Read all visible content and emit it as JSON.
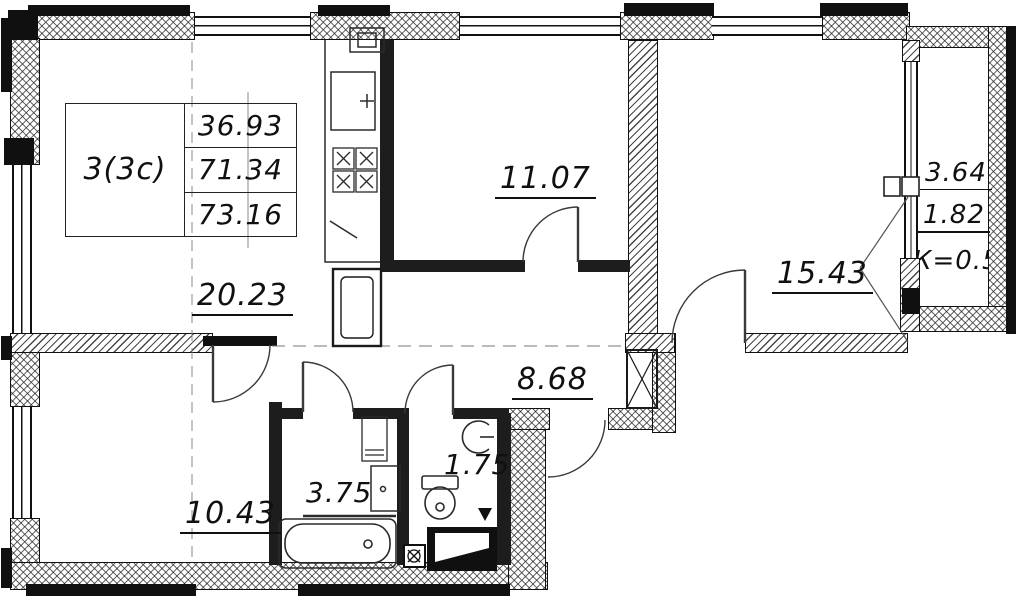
{
  "drawing": {
    "title_block": {
      "apartment_type": "3(3с)",
      "living_area": "36.93",
      "apartment_area": "71.34",
      "total_area": "73.16"
    },
    "room_areas": {
      "living_kitchen": "20.23",
      "bedroom_top": "11.07",
      "bedroom_right": "15.43",
      "hall": "8.68",
      "bedroom_left": "10.43",
      "bathroom": "3.75",
      "wc": "1.75"
    },
    "loggia": {
      "area_full": "3.64",
      "area_counted": "1.82",
      "coefficient": "К=0.5"
    }
  },
  "colors": {
    "ink": "#1a1a1a",
    "background": "#ffffff"
  }
}
